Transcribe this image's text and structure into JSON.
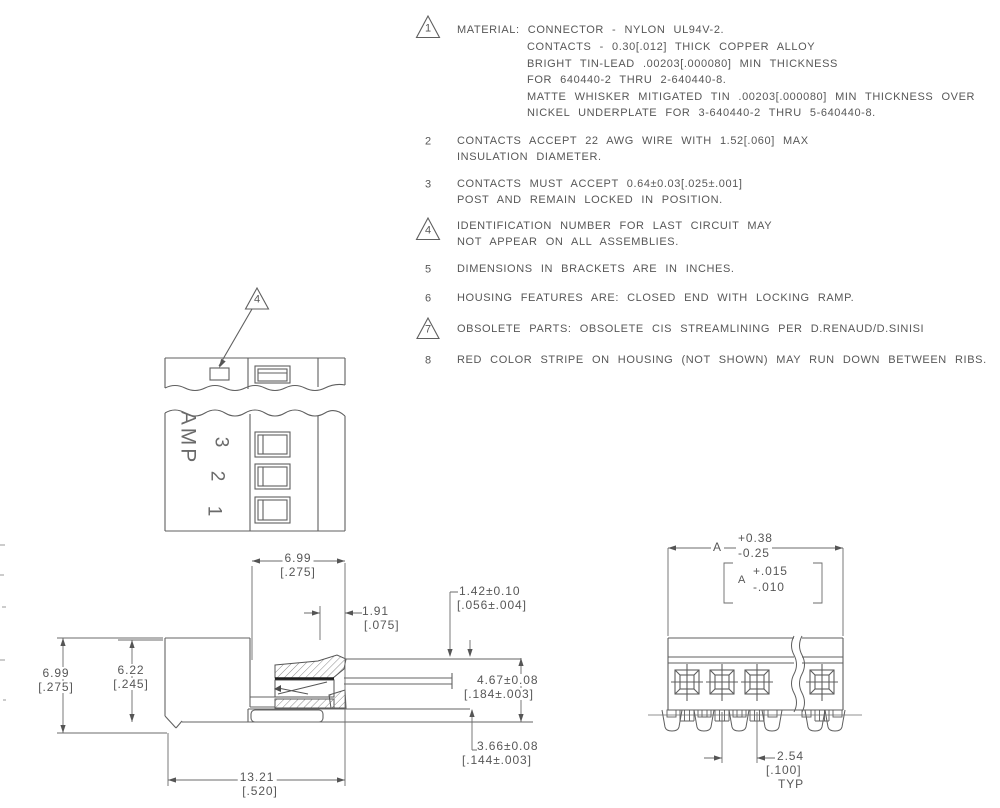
{
  "notes": [
    {
      "num": "1",
      "lines": [
        "MATERIAL: CONNECTOR - NYLON UL94V-2.",
        "CONTACTS - 0.30[.012] THICK COPPER ALLOY",
        "BRIGHT TIN-LEAD .00203[.000080] MIN THICKNESS",
        "FOR 640440-2 THRU 2-640440-8.",
        "MATTE WHISKER MITIGATED TIN .00203[.000080] MIN THICKNESS OVER",
        "NICKEL UNDERPLATE FOR 3-640440-2 THRU 5-640440-8."
      ]
    },
    {
      "num": "2",
      "lines": [
        "CONTACTS ACCEPT 22 AWG WIRE WITH 1.52[.060] MAX",
        "INSULATION DIAMETER."
      ]
    },
    {
      "num": "3",
      "lines": [
        "CONTACTS MUST ACCEPT 0.64±0.03[.025±.001]",
        "POST AND REMAIN LOCKED IN POSITION."
      ]
    },
    {
      "num": "4",
      "lines": [
        "IDENTIFICATION NUMBER FOR LAST CIRCUIT MAY",
        "NOT APPEAR ON ALL ASSEMBLIES."
      ]
    },
    {
      "num": "5",
      "lines": [
        "DIMENSIONS IN BRACKETS ARE IN INCHES."
      ]
    },
    {
      "num": "6",
      "lines": [
        "HOUSING FEATURES ARE: CLOSED END WITH LOCKING RAMP."
      ]
    },
    {
      "num": "7",
      "lines": [
        "OBSOLETE PARTS: OBSOLETE CIS STREAMLINING PER D.RENAUD/D.SINISI"
      ]
    },
    {
      "num": "8",
      "lines": [
        "RED COLOR STRIPE ON HOUSING (NOT SHOWN) MAY RUN DOWN BETWEEN RIBS."
      ]
    }
  ],
  "plan": {
    "balloon": "4"
  },
  "side": {
    "brand": "AMP",
    "pos3": "3",
    "pos2": "2",
    "pos1": "1"
  },
  "sec": {
    "w_top_mm": "6.99",
    "w_top_in": "[.275]",
    "h_out_mm": "6.99",
    "h_out_in": "[.275]",
    "h_in_mm": "6.22",
    "h_in_in": "[.245]",
    "off_mm": "1.91",
    "off_in": "[.075]",
    "tab_mm": "1.42±0.10",
    "tab_in": "[.056±.004]",
    "d1_mm": "4.67±0.08",
    "d1_in": "[.184±.003]",
    "d2_mm": "3.66±0.08",
    "d2_in": "[.144±.003]",
    "len_mm": "13.21",
    "len_in": "[.520]"
  },
  "front": {
    "a": "A",
    "a_plus": "+0.38",
    "a_minus": "-0.25",
    "ab": "A",
    "ab_plus": "+.015",
    "ab_minus": "-.010",
    "pitch_mm": "2.54",
    "pitch_in": "[.100]",
    "typ": "TYP"
  }
}
